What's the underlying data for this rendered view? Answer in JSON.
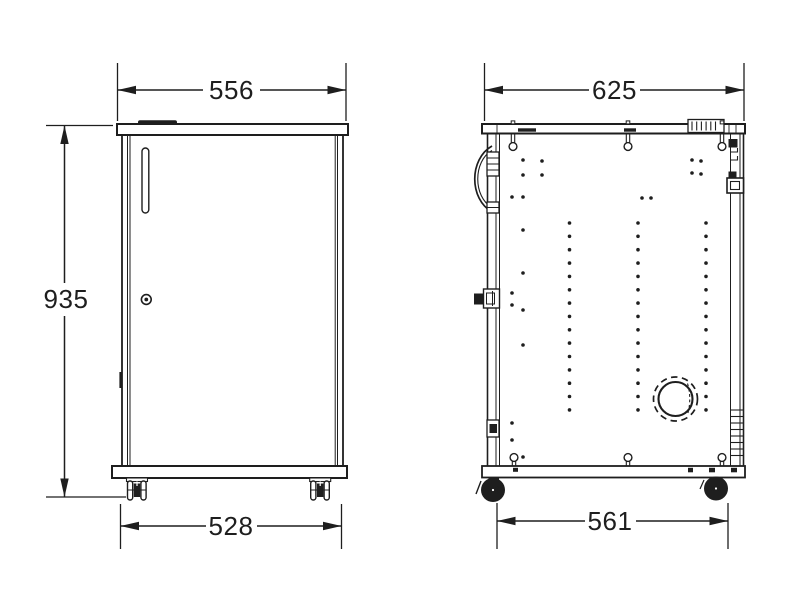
{
  "page": {
    "background": "#ffffff"
  },
  "drawing": {
    "line_color": "#1e1e1e",
    "dimensions": {
      "front_width_top": "556",
      "front_height": "935",
      "front_width_bottom": "528",
      "side_depth_top": "625",
      "side_depth_bottom": "561"
    },
    "side_view_details": {
      "rivet_columns": [
        {
          "x": 569.5,
          "y_start": 223,
          "spacing": 13.35,
          "count": 15
        },
        {
          "x": 638.0,
          "y_start": 223,
          "spacing": 13.35,
          "count": 15
        },
        {
          "x": 706.0,
          "y_start": 223,
          "spacing": 13.35,
          "count": 15
        }
      ],
      "extra_rivets": [
        [
          523,
          160
        ],
        [
          523,
          175
        ],
        [
          542,
          161
        ],
        [
          542,
          175
        ],
        [
          512,
          197
        ],
        [
          523,
          197
        ],
        [
          642,
          198
        ],
        [
          651,
          198
        ],
        [
          692,
          160
        ],
        [
          692,
          173
        ],
        [
          701,
          161
        ],
        [
          701,
          174
        ],
        [
          523,
          230
        ],
        [
          523,
          273
        ],
        [
          512,
          293
        ],
        [
          512,
          305
        ],
        [
          523,
          310
        ],
        [
          523,
          345
        ],
        [
          512,
          423
        ],
        [
          512,
          440
        ],
        [
          523,
          457
        ]
      ],
      "top_hooks_x": [
        513,
        628,
        722
      ],
      "bottom_hooks_x": [
        514,
        628,
        722
      ],
      "hatch_groups": [
        {
          "dir": "v",
          "from": 692,
          "to": 720,
          "step": 4.7,
          "a1": 121.5,
          "a2": 130.5
        },
        {
          "dir": "v",
          "from": 558,
          "to": 602,
          "step": 4.9,
          "a1": 467.8,
          "a2": 475.4
        },
        {
          "dir": "h",
          "from": 410,
          "to": 456,
          "step": 6.5,
          "a1": 730.5,
          "a2": 743.5
        }
      ]
    }
  }
}
